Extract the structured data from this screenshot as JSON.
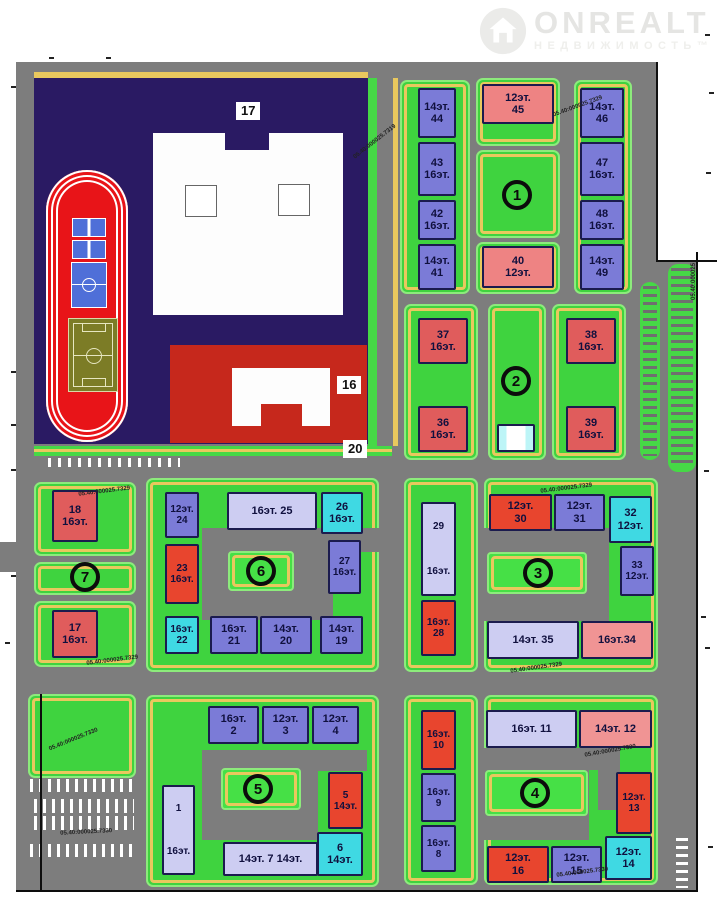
{
  "watermark": {
    "brand": "ONREALT",
    "sub": "НЕДВИЖИМОСТЬ™"
  },
  "palette": {
    "road": "#7d7d7d",
    "yard_green": "#3fd33f",
    "yard_edge": "#8deb7c",
    "path_yellow": "#e9c85e",
    "building_blue": "#7b7bd7",
    "building_lavender": "#cdcdf2",
    "building_cyan": "#3fd9e3",
    "building_red": "#e8452e",
    "building_dark_red": "#e05c5c",
    "building_pink": "#ee8383",
    "building_salmon": "#f09494",
    "campus_navy": "#2a1a63",
    "kindergarten_red": "#c6281c",
    "track_red": "#e81418",
    "field_olive": "#7c7c26",
    "court_blue": "#4f6fd8"
  },
  "plan": {
    "quarter_circles": [
      {
        "n": "1",
        "x": 518,
        "y": 196
      },
      {
        "n": "2",
        "x": 517,
        "y": 382
      },
      {
        "n": "3",
        "x": 539,
        "y": 574
      },
      {
        "n": "4",
        "x": 536,
        "y": 794
      },
      {
        "n": "5",
        "x": 259,
        "y": 790
      },
      {
        "n": "6",
        "x": 262,
        "y": 572
      },
      {
        "n": "7",
        "x": 86,
        "y": 578
      }
    ],
    "facility_labels": [
      {
        "t": "17",
        "x": 236,
        "y": 102
      },
      {
        "t": "16",
        "x": 337,
        "y": 376
      },
      {
        "t": "20",
        "x": 343,
        "y": 440
      }
    ],
    "cadastral": [
      {
        "t": "05.40:000025.7319",
        "x": 352,
        "y": 155,
        "r": -38
      },
      {
        "t": "05.40:000025.7329",
        "x": 552,
        "y": 112,
        "r": -20
      },
      {
        "t": "05.40:000025.7329",
        "x": 78,
        "y": 491,
        "r": -7
      },
      {
        "t": "05.40:000025.7329",
        "x": 86,
        "y": 660,
        "r": -7
      },
      {
        "t": "05.40:000025.7329",
        "x": 540,
        "y": 488,
        "r": -7
      },
      {
        "t": "05.40:000025.7329",
        "x": 510,
        "y": 668,
        "r": -8
      },
      {
        "t": "05.40:000025.7330",
        "x": 48,
        "y": 746,
        "r": -22
      },
      {
        "t": "05.40:000025.7330",
        "x": 60,
        "y": 830,
        "r": -3
      },
      {
        "t": "05.40:000025.7330",
        "x": 584,
        "y": 752,
        "r": -10
      },
      {
        "t": "05.40:000025.7330",
        "x": 556,
        "y": 872,
        "r": -7
      },
      {
        "t": "05.40:000025",
        "x": 690,
        "y": 300,
        "r": -90
      }
    ],
    "zones": [
      {
        "id": "q1-left",
        "x": 400,
        "y": 80,
        "w": 70,
        "h": 214
      },
      {
        "id": "q1-top",
        "x": 476,
        "y": 78,
        "w": 84,
        "h": 68
      },
      {
        "id": "q1-court",
        "x": 476,
        "y": 150,
        "w": 84,
        "h": 88
      },
      {
        "id": "q1-bottom",
        "x": 476,
        "y": 242,
        "w": 84,
        "h": 52
      },
      {
        "id": "q1-right",
        "x": 574,
        "y": 80,
        "w": 58,
        "h": 214
      },
      {
        "id": "q2-left",
        "x": 404,
        "y": 304,
        "w": 74,
        "h": 156
      },
      {
        "id": "q2-mid",
        "x": 488,
        "y": 304,
        "w": 58,
        "h": 156
      },
      {
        "id": "q2-right",
        "x": 552,
        "y": 304,
        "w": 74,
        "h": 156
      },
      {
        "id": "q7-top",
        "x": 34,
        "y": 482,
        "w": 102,
        "h": 74
      },
      {
        "id": "q7-mid",
        "x": 34,
        "y": 562,
        "w": 102,
        "h": 33
      },
      {
        "id": "q7-bottom",
        "x": 34,
        "y": 601,
        "w": 102,
        "h": 66
      },
      {
        "id": "q6",
        "x": 146,
        "y": 478,
        "w": 233,
        "h": 194
      },
      {
        "id": "q3-left",
        "x": 404,
        "y": 478,
        "w": 74,
        "h": 194
      },
      {
        "id": "q3-main",
        "x": 484,
        "y": 478,
        "w": 174,
        "h": 194
      },
      {
        "id": "q5",
        "x": 146,
        "y": 695,
        "w": 233,
        "h": 192
      },
      {
        "id": "q4-left",
        "x": 404,
        "y": 695,
        "w": 74,
        "h": 190
      },
      {
        "id": "q4-main",
        "x": 484,
        "y": 695,
        "w": 174,
        "h": 190
      },
      {
        "id": "sw-green",
        "x": 28,
        "y": 694,
        "w": 108,
        "h": 84
      }
    ],
    "carves": [
      {
        "x": 202,
        "y": 528,
        "w": 131,
        "h": 92
      },
      {
        "x": 333,
        "y": 528,
        "w": 47,
        "h": 24
      },
      {
        "x": 483,
        "y": 528,
        "w": 126,
        "h": 93
      },
      {
        "x": 202,
        "y": 750,
        "w": 165,
        "h": 21
      },
      {
        "x": 202,
        "y": 750,
        "w": 116,
        "h": 90
      },
      {
        "x": 483,
        "y": 748,
        "w": 137,
        "h": 22
      },
      {
        "x": 483,
        "y": 748,
        "w": 106,
        "h": 92
      },
      {
        "x": 598,
        "y": 748,
        "w": 22,
        "h": 62
      }
    ],
    "courts": [
      {
        "id": "q6-court",
        "x": 228,
        "y": 551,
        "w": 66,
        "h": 40
      },
      {
        "id": "q3-court",
        "x": 487,
        "y": 552,
        "w": 100,
        "h": 42
      },
      {
        "id": "q5-court",
        "x": 221,
        "y": 768,
        "w": 80,
        "h": 42
      },
      {
        "id": "q4-court",
        "x": 485,
        "y": 770,
        "w": 103,
        "h": 46
      }
    ],
    "buildings": [
      {
        "id": "44",
        "lines": [
          "14эт.",
          "44"
        ],
        "c": "blue",
        "x": 418,
        "y": 88,
        "w": 38,
        "h": 50
      },
      {
        "id": "43",
        "lines": [
          "43",
          "16эт."
        ],
        "c": "blue",
        "x": 418,
        "y": 142,
        "w": 38,
        "h": 54
      },
      {
        "id": "42",
        "lines": [
          "42",
          "16эт."
        ],
        "c": "blue",
        "x": 418,
        "y": 200,
        "w": 38,
        "h": 40
      },
      {
        "id": "41",
        "lines": [
          "14эт.",
          "41"
        ],
        "c": "blue",
        "x": 418,
        "y": 244,
        "w": 38,
        "h": 46
      },
      {
        "id": "45",
        "lines": [
          "12эт.",
          "45"
        ],
        "c": "pink",
        "x": 482,
        "y": 84,
        "w": 72,
        "h": 40
      },
      {
        "id": "40",
        "lines": [
          "40",
          "12эт."
        ],
        "c": "pink",
        "x": 482,
        "y": 246,
        "w": 72,
        "h": 42
      },
      {
        "id": "46",
        "lines": [
          "14эт.",
          "46"
        ],
        "c": "blue",
        "x": 580,
        "y": 88,
        "w": 44,
        "h": 50
      },
      {
        "id": "47",
        "lines": [
          "47",
          "16эт."
        ],
        "c": "blue",
        "x": 580,
        "y": 142,
        "w": 44,
        "h": 54
      },
      {
        "id": "48",
        "lines": [
          "48",
          "16эт."
        ],
        "c": "blue",
        "x": 580,
        "y": 200,
        "w": 44,
        "h": 40
      },
      {
        "id": "49",
        "lines": [
          "14эт.",
          "49"
        ],
        "c": "blue",
        "x": 580,
        "y": 244,
        "w": 44,
        "h": 46
      },
      {
        "id": "37",
        "lines": [
          "37",
          "16эт."
        ],
        "c": "dred",
        "x": 418,
        "y": 318,
        "w": 50,
        "h": 46
      },
      {
        "id": "36",
        "lines": [
          "36",
          "16эт."
        ],
        "c": "dred",
        "x": 418,
        "y": 406,
        "w": 50,
        "h": 46
      },
      {
        "id": "38",
        "lines": [
          "38",
          "16эт."
        ],
        "c": "dred",
        "x": 566,
        "y": 318,
        "w": 50,
        "h": 46
      },
      {
        "id": "39",
        "lines": [
          "39",
          "16эт."
        ],
        "c": "dred",
        "x": 566,
        "y": 406,
        "w": 50,
        "h": 46
      },
      {
        "id": "q2-small",
        "lines": [],
        "c": "wc",
        "x": 497,
        "y": 424,
        "w": 38,
        "h": 28
      },
      {
        "id": "18",
        "lines": [
          "18",
          "16эт."
        ],
        "c": "dred",
        "x": 52,
        "y": 490,
        "w": 46,
        "h": 52
      },
      {
        "id": "17",
        "lines": [
          "17",
          "16эт."
        ],
        "c": "dred",
        "x": 52,
        "y": 610,
        "w": 46,
        "h": 48
      },
      {
        "id": "24",
        "lines": [
          "12эт.",
          "24"
        ],
        "c": "blue",
        "x": 165,
        "y": 492,
        "w": 34,
        "h": 46
      },
      {
        "id": "25",
        "lines": [
          "16эт.  25"
        ],
        "c": "lav",
        "x": 227,
        "y": 492,
        "w": 90,
        "h": 38
      },
      {
        "id": "26",
        "lines": [
          "26",
          "16эт."
        ],
        "c": "cyan",
        "x": 321,
        "y": 492,
        "w": 42,
        "h": 42
      },
      {
        "id": "23",
        "lines": [
          "23",
          "16эт."
        ],
        "c": "red",
        "x": 165,
        "y": 544,
        "w": 34,
        "h": 60
      },
      {
        "id": "27",
        "lines": [
          "27",
          "16эт."
        ],
        "c": "blue",
        "x": 328,
        "y": 540,
        "w": 33,
        "h": 54
      },
      {
        "id": "22",
        "lines": [
          "16эт.",
          "22"
        ],
        "c": "cyan",
        "x": 165,
        "y": 616,
        "w": 34,
        "h": 38
      },
      {
        "id": "21",
        "lines": [
          "16эт.",
          "21"
        ],
        "c": "blue",
        "x": 210,
        "y": 616,
        "w": 48,
        "h": 38
      },
      {
        "id": "20",
        "lines": [
          "14эт.",
          "20"
        ],
        "c": "blue",
        "x": 260,
        "y": 616,
        "w": 52,
        "h": 38
      },
      {
        "id": "19",
        "lines": [
          "14эт.",
          "19"
        ],
        "c": "blue",
        "x": 320,
        "y": 616,
        "w": 43,
        "h": 38
      },
      {
        "id": "29",
        "lines": [
          "29",
          "16эт."
        ],
        "c": "lav",
        "x": 421,
        "y": 502,
        "w": 35,
        "h": 94
      },
      {
        "id": "28",
        "lines": [
          "16эт.",
          "28"
        ],
        "c": "red",
        "x": 421,
        "y": 600,
        "w": 35,
        "h": 56
      },
      {
        "id": "30",
        "lines": [
          "12эт.",
          "30"
        ],
        "c": "red",
        "x": 489,
        "y": 494,
        "w": 63,
        "h": 37
      },
      {
        "id": "31",
        "lines": [
          "12эт.",
          "31"
        ],
        "c": "blue",
        "x": 554,
        "y": 494,
        "w": 51,
        "h": 37
      },
      {
        "id": "32",
        "lines": [
          "32",
          "12эт."
        ],
        "c": "cyan",
        "x": 609,
        "y": 496,
        "w": 43,
        "h": 47
      },
      {
        "id": "33",
        "lines": [
          "33",
          "12эт."
        ],
        "c": "blue",
        "x": 620,
        "y": 546,
        "w": 34,
        "h": 50
      },
      {
        "id": "35",
        "lines": [
          "14эт.  35"
        ],
        "c": "lav",
        "x": 487,
        "y": 621,
        "w": 92,
        "h": 38
      },
      {
        "id": "34",
        "lines": [
          "16эт.34"
        ],
        "c": "salmon",
        "x": 581,
        "y": 621,
        "w": 72,
        "h": 38
      },
      {
        "id": "2",
        "lines": [
          "16эт.",
          "2"
        ],
        "c": "blue",
        "x": 208,
        "y": 706,
        "w": 51,
        "h": 38
      },
      {
        "id": "3",
        "lines": [
          "12эт.",
          "3"
        ],
        "c": "blue",
        "x": 262,
        "y": 706,
        "w": 47,
        "h": 38
      },
      {
        "id": "4",
        "lines": [
          "12эт.",
          "4"
        ],
        "c": "blue",
        "x": 312,
        "y": 706,
        "w": 47,
        "h": 38
      },
      {
        "id": "1",
        "lines": [
          "1",
          "16эт."
        ],
        "c": "lav",
        "x": 162,
        "y": 785,
        "w": 33,
        "h": 90
      },
      {
        "id": "5",
        "lines": [
          "5",
          "14эт."
        ],
        "c": "red",
        "x": 328,
        "y": 772,
        "w": 35,
        "h": 57
      },
      {
        "id": "6",
        "lines": [
          "6",
          "14эт."
        ],
        "c": "cyan",
        "x": 317,
        "y": 832,
        "w": 46,
        "h": 44
      },
      {
        "id": "7",
        "lines": [
          "14эт. 7 14эт."
        ],
        "c": "lav",
        "x": 223,
        "y": 842,
        "w": 95,
        "h": 34
      },
      {
        "id": "10",
        "lines": [
          "16эт.",
          "10"
        ],
        "c": "red",
        "x": 421,
        "y": 710,
        "w": 35,
        "h": 60
      },
      {
        "id": "9",
        "lines": [
          "16эт.",
          "9"
        ],
        "c": "blue",
        "x": 421,
        "y": 773,
        "w": 35,
        "h": 49
      },
      {
        "id": "8",
        "lines": [
          "16эт.",
          "8"
        ],
        "c": "blue",
        "x": 421,
        "y": 825,
        "w": 35,
        "h": 47
      },
      {
        "id": "11",
        "lines": [
          "16эт.  11"
        ],
        "c": "lav",
        "x": 486,
        "y": 710,
        "w": 91,
        "h": 38
      },
      {
        "id": "12",
        "lines": [
          "14эт. 12"
        ],
        "c": "salmon",
        "x": 579,
        "y": 710,
        "w": 73,
        "h": 38
      },
      {
        "id": "13",
        "lines": [
          "12эт.",
          "13"
        ],
        "c": "red",
        "x": 616,
        "y": 772,
        "w": 36,
        "h": 62
      },
      {
        "id": "14",
        "lines": [
          "12эт.",
          "14"
        ],
        "c": "cyan",
        "x": 605,
        "y": 836,
        "w": 47,
        "h": 44
      },
      {
        "id": "16",
        "lines": [
          "12эт.",
          "16"
        ],
        "c": "red",
        "x": 487,
        "y": 846,
        "w": 62,
        "h": 37
      },
      {
        "id": "15",
        "lines": [
          "12эт.",
          "15"
        ],
        "c": "blue",
        "x": 551,
        "y": 846,
        "w": 51,
        "h": 37
      }
    ],
    "ticks": [
      [
        11,
        86
      ],
      [
        11,
        371
      ],
      [
        11,
        424
      ],
      [
        11,
        469
      ],
      [
        11,
        575
      ],
      [
        5,
        642
      ],
      [
        49,
        57
      ],
      [
        106,
        57
      ],
      [
        705,
        34
      ],
      [
        709,
        92
      ],
      [
        706,
        172
      ],
      [
        704,
        470
      ],
      [
        701,
        616
      ],
      [
        705,
        647
      ],
      [
        708,
        846
      ]
    ]
  }
}
